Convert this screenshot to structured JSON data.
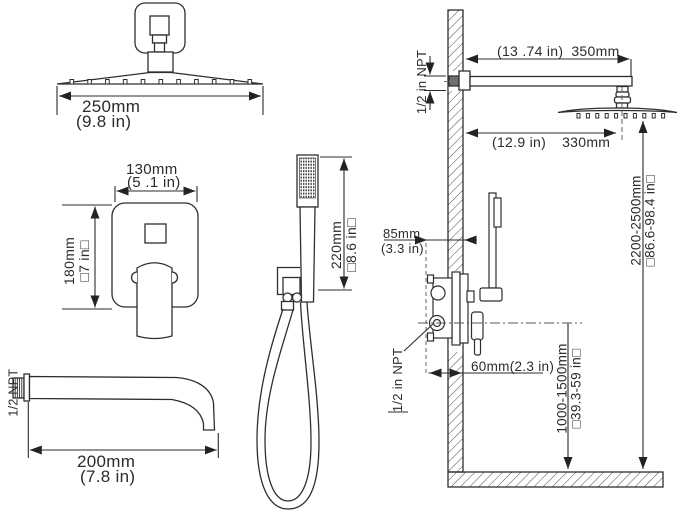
{
  "diagram": {
    "rain_head": {
      "width_mm": "250mm",
      "width_in": "(9.8  in)"
    },
    "valve_trim": {
      "width_mm": "130mm",
      "width_in": "(5 .1 in)",
      "height_mm": "180mm",
      "height_in": "□7 in□"
    },
    "hand_shower": {
      "length_mm": "220mm",
      "length_in": "□8.6 in□"
    },
    "tub_spout": {
      "length_mm": "200mm",
      "length_in": "(7.8 in)",
      "thread": "1/2 NPT"
    },
    "installation": {
      "arm_length_in": "(13 .74 in)",
      "arm_length_mm": "350mm",
      "arm_thread": "1/2 in NPT",
      "head_offset_in": "(12.9 in)",
      "head_offset_mm": "330mm",
      "head_height_mm": "2200-2500mm",
      "head_height_in": "□86.6-98.4 in□",
      "valve_depth_mm": "85mm",
      "valve_depth_in": "(3.3 in)",
      "valve_thread": "1/2 in NPT",
      "spout_offset": "60mm(2.3 in)",
      "valve_height_mm": "1000-1500mm",
      "valve_height_in": "□39.3-59 in□"
    }
  }
}
